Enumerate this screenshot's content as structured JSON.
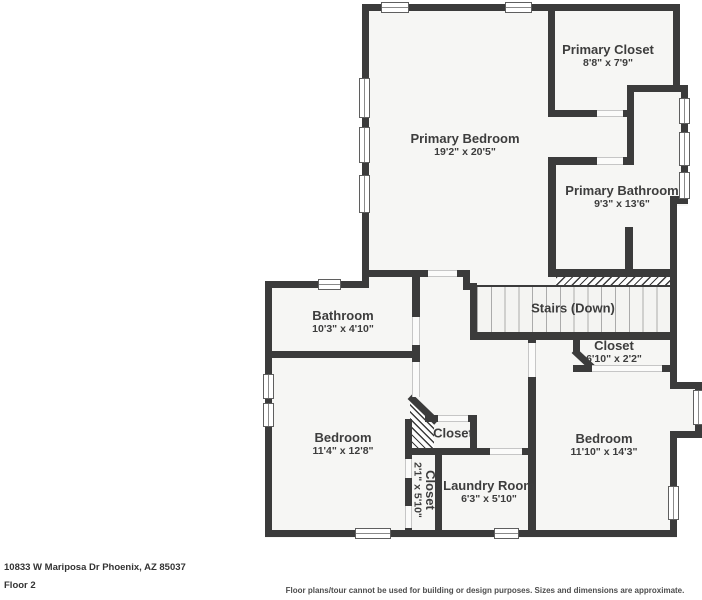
{
  "rooms": [
    {
      "id": "primary-bedroom",
      "label": "Primary Bedroom",
      "dims": "19'2\" x 20'5\""
    },
    {
      "id": "primary-closet",
      "label": "Primary Closet",
      "dims": "8'8\" x 7'9\""
    },
    {
      "id": "primary-bathroom",
      "label": "Primary Bathroom",
      "dims": "9'3\" x 13'6\""
    },
    {
      "id": "bathroom",
      "label": "Bathroom",
      "dims": "10'3\" x 4'10\""
    },
    {
      "id": "stairs",
      "label": "Stairs (Down)",
      "dims": ""
    },
    {
      "id": "hall-closet",
      "label": "Closet",
      "dims": "6'10\" x 2'2\""
    },
    {
      "id": "bedroom-left",
      "label": "Bedroom",
      "dims": "11'4\" x 12'8\""
    },
    {
      "id": "small-closet",
      "label": "Closet",
      "dims": ""
    },
    {
      "id": "narrow-closet",
      "label": "Closet",
      "dims": "2'1\" x 5'10\""
    },
    {
      "id": "laundry-room",
      "label": "Laundry Room",
      "dims": "6'3\" x 5'10\""
    },
    {
      "id": "bedroom-right",
      "label": "Bedroom",
      "dims": "11'10\" x 14'3\""
    }
  ],
  "footer": {
    "address": "10833 W Mariposa Dr Phoenix, AZ 85037",
    "floor": "Floor 2",
    "disclaimer": "Floor plans/tour cannot be used for building or design purposes. Sizes and dimensions are approximate."
  },
  "colors": {
    "wall": "#3b3b3b",
    "floor": "#f6f6f4",
    "text": "#3d3d3d"
  }
}
